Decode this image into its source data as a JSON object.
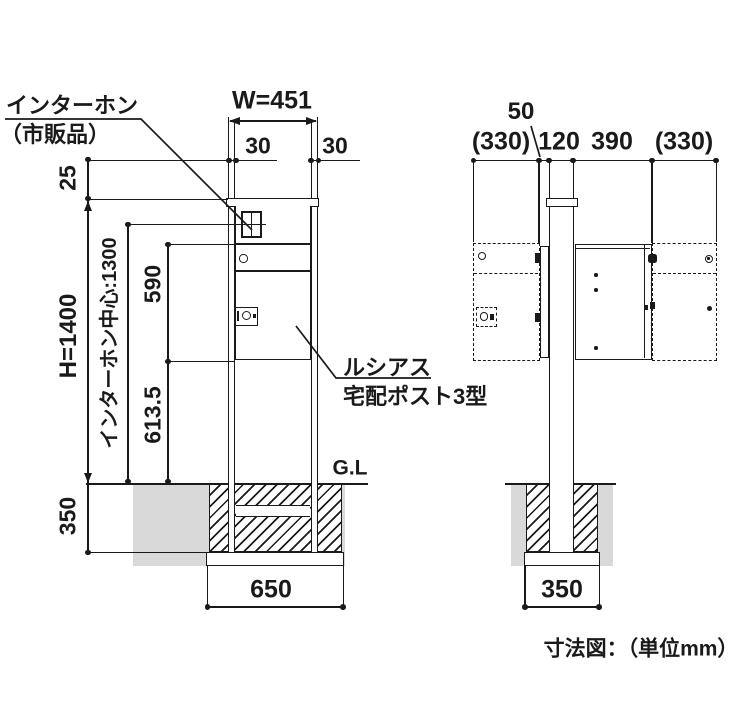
{
  "caption": "寸法図：（単位mm）",
  "front": {
    "intercom_label_1": "インターホン",
    "intercom_label_2": "（市販品）",
    "product_label_1": "ルシアス",
    "product_label_2": "宅配ポスト3型",
    "ground_label": "G.L",
    "dim_width": "W=451",
    "dim_post_left": "30",
    "dim_post_right": "30",
    "dim_top_offset": "25",
    "dim_height": "H=1400",
    "dim_intercom_center": "インターホン中心:1300",
    "dim_door_height": "590",
    "dim_lower_height": "613.5",
    "dim_embed_depth": "350",
    "dim_footing_width": "650"
  },
  "side": {
    "dim_door_thickness": "50",
    "dim_front_clearance": "(330)",
    "dim_post_depth": "120",
    "dim_box_depth": "390",
    "dim_rear_clearance": "(330)",
    "dim_footing_width": "350"
  },
  "colors": {
    "line": "#1a1a1a",
    "soil": "#d9d9d9"
  }
}
